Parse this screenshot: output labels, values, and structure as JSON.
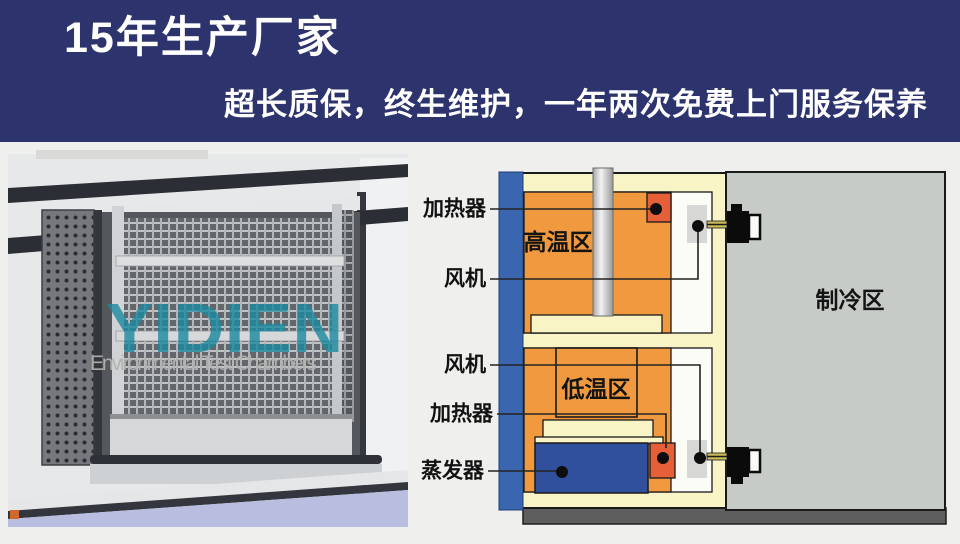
{
  "header": {
    "title": "15年生产厂家",
    "subtitle": "超长质保，终生维护，一年两次免费上门服务保养",
    "background_color": "#2d336d",
    "text_color": "#ffffff"
  },
  "photo": {
    "watermark": "YIDIEN",
    "watermark_subtitle": "Environmental Test Chambers",
    "watermark_color": "#1b8aa0"
  },
  "diagram": {
    "callouts": {
      "heater_top": "加热器",
      "fan_top": "风机",
      "fan_bottom": "风机",
      "heater_bottom": "加热器",
      "evaporator": "蒸发器"
    },
    "zones": {
      "hot": "高温区",
      "cold": "低温区",
      "cooling": "制冷区"
    },
    "colors": {
      "hot_zone_orange": "#f0993f",
      "insulation_cream": "#f8f4c6",
      "cooling_zone_gray": "#c7cbc7",
      "frame_blue": "#3a66af",
      "heater_red": "#e55f39",
      "evaporator_blue": "#30509e",
      "base_gray": "#5e5e5e"
    }
  }
}
